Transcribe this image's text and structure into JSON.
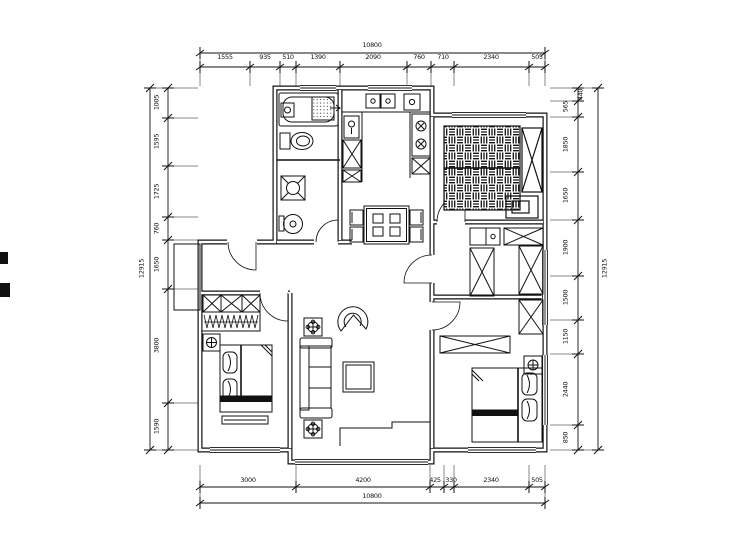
{
  "drawing": {
    "title": "apartment-floor-plan",
    "units": "mm",
    "ink_color": "#1a1a1a",
    "background_color": "#ffffff"
  },
  "dims": {
    "top": {
      "total": "10800",
      "segments": [
        "1555",
        "935",
        "510",
        "1390",
        "2090",
        "760",
        "710",
        "2340",
        "505"
      ]
    },
    "bottom": {
      "total": "10800",
      "segments": [
        "3000",
        "4200",
        "425",
        "330",
        "2340",
        "505"
      ]
    },
    "left": {
      "total": "12915",
      "segments": [
        "1005",
        "1595",
        "1725",
        "760",
        "1650",
        "3800",
        "1590"
      ]
    },
    "right": {
      "total": "12915",
      "segments": [
        "440",
        "565",
        "1850",
        "1650",
        "1900",
        "1500",
        "1150",
        "2440",
        "850"
      ]
    }
  },
  "plan": {
    "rooms": [
      "bathroom",
      "kitchen",
      "dining-area",
      "living-room",
      "entry",
      "bedroom-left",
      "bedroom-top-right",
      "walk-in-closet",
      "bedroom-bottom-right"
    ],
    "icons": [
      "bathtub-icon",
      "shower-icon",
      "toilet-icon",
      "washing-machine-icon",
      "water-heater-icon",
      "kitchen-sink-icon",
      "stove-icon",
      "dining-table-icon",
      "sofa-icon",
      "coffee-table-icon",
      "armchair-icon",
      "tv-cabinet-icon",
      "wardrobe-icon",
      "hanging-rail-icon",
      "double-bed-icon",
      "nightstand-plant-icon",
      "desk-icon",
      "dresser-icon",
      "door-arc-icon",
      "window-icon"
    ]
  }
}
